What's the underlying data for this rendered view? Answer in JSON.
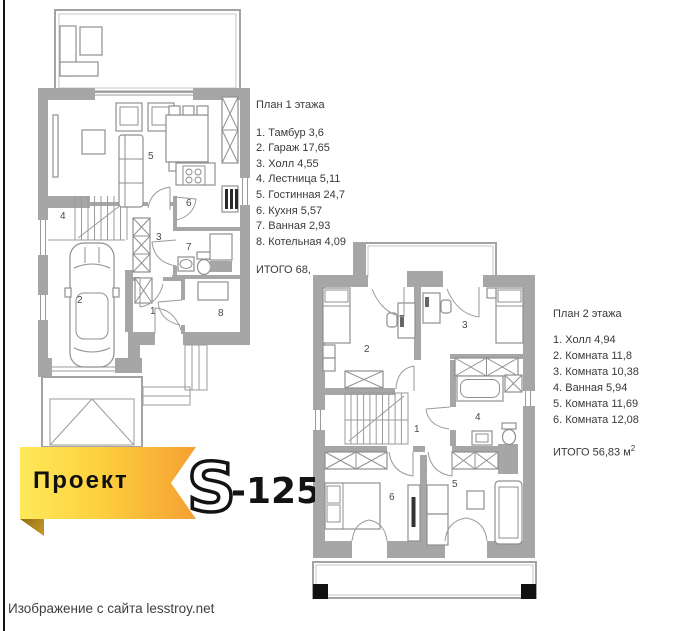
{
  "plan1": {
    "title": "План 1 этажа",
    "items": [
      "1. Тамбур 3,6",
      "2. Гараж 17,65",
      "3. Холл 4,55",
      "4. Лестница 5,11",
      "5. Гостинная 24,7",
      "6. Кухня 5,57",
      "7. Ванная 2,93",
      "8. Котельная 4,09"
    ],
    "total": "ИТОГО 68,",
    "rooms": {
      "r1": "1",
      "r2": "2",
      "r3": "3",
      "r4": "4",
      "r5": "5",
      "r6": "6",
      "r7": "7",
      "r8": "8"
    }
  },
  "plan2": {
    "title": "План 2 этажа",
    "items": [
      "1. Холл 4,94",
      "2. Комната 11,8",
      "3. Комната 10,38",
      "4. Ванная 5,94",
      "5. Комната 11,69",
      "6. Комната 12,08"
    ],
    "total_prefix": "ИТОГО 56,83 м",
    "total_sup": "2",
    "rooms": {
      "r1": "1",
      "r2": "2",
      "r3": "3",
      "r4": "4",
      "r5": "5",
      "r6": "6"
    }
  },
  "banner": {
    "project_label": "Проект",
    "series_letter": "S",
    "series_number": "-125",
    "colors": {
      "gradient_start": "#ffe95a",
      "gradient_end": "#f5a033",
      "fold": "#8f6c12",
      "text": "#101010"
    }
  },
  "watermark": {
    "text": "Изображение с сайта lesstroy.net"
  },
  "colors": {
    "wall_gray": "#a6a6a6",
    "line_gray": "#9b9b9b",
    "label_gray": "#4a4a4a",
    "page_border": "#141414"
  }
}
